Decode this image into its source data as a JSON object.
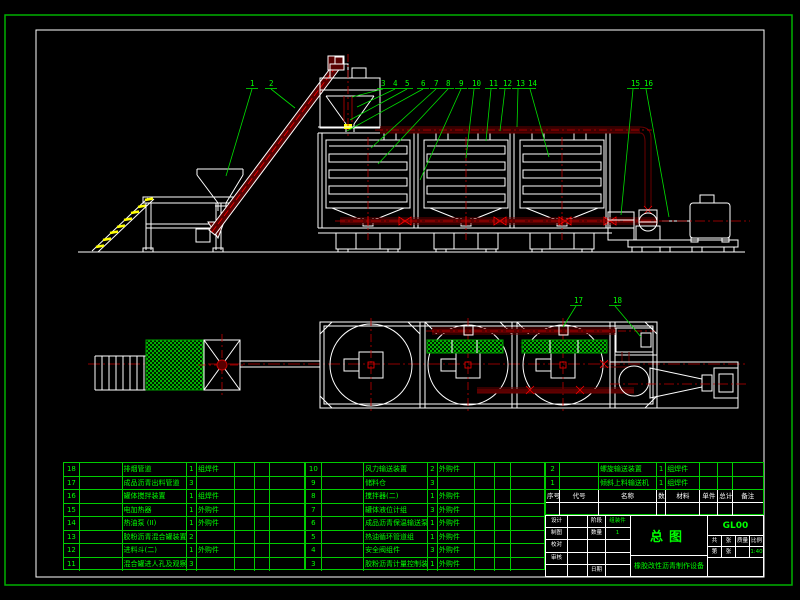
{
  "sheet": {
    "type": "CAD assembly drawing",
    "colors": {
      "background": "#000000",
      "outer_frame_green": "#00b000",
      "inner_frame_white": "#ffffff",
      "drawing_white": "#ffffff",
      "pipe_maroon": "#6a0000",
      "centerline_red": "#cc0000",
      "valve_red": "#ff0000",
      "callout_green": "#00ff00",
      "table_green": "#00cc00",
      "stair_yellow": "#ffff00",
      "hatch_green": "#00b400"
    }
  },
  "title_block": {
    "drawing_title": "总图",
    "drawing_no": "GL00",
    "product_name": "橡胶改性沥青制作设备",
    "scale_value": "1:40",
    "sig_rows": [
      [
        "设计",
        "",
        "阶段",
        "组装件"
      ],
      [
        "制图",
        "",
        "数量",
        "1"
      ],
      [
        "校对",
        "",
        "",
        ""
      ],
      [
        "审核",
        "",
        "",
        ""
      ],
      [
        "",
        "",
        "日期",
        ""
      ]
    ],
    "info_row1": [
      "共",
      "张",
      "质量",
      "比例"
    ],
    "info_row2": [
      "第",
      "张",
      "",
      "1:40"
    ]
  },
  "bom": {
    "header": [
      "序号",
      "代号",
      "名称",
      "数量",
      "材料",
      "单件",
      "总计",
      "备注"
    ],
    "left_rows": [
      [
        "18",
        "",
        "排烟管道",
        "1",
        "组焊件"
      ],
      [
        "17",
        "",
        "成品沥青出料管道",
        "3",
        ""
      ],
      [
        "16",
        "",
        "罐体搅拌装置",
        "1",
        "组焊件"
      ],
      [
        "15",
        "",
        "电加热器",
        "1",
        "外购件"
      ],
      [
        "14",
        "",
        "热油泵 (II)",
        "1",
        "外购件"
      ],
      [
        "13",
        "",
        "胶粉沥青混合罐装置",
        "2",
        ""
      ],
      [
        "12",
        "",
        "进料斗(二)",
        "1",
        "外购件"
      ],
      [
        "11",
        "",
        "混合罐进人孔及观察装置",
        "3",
        ""
      ]
    ],
    "middle_rows": [
      [
        "10",
        "",
        "风力输送装置",
        "2",
        "外购件"
      ],
      [
        "9",
        "",
        "储料仓",
        "3",
        ""
      ],
      [
        "8",
        "",
        "搅拌器(二)",
        "1",
        "外购件"
      ],
      [
        "7",
        "",
        "罐体液位计组",
        "3",
        "外购件"
      ],
      [
        "6",
        "",
        "成品沥青保温输送泵",
        "1",
        "外购件"
      ],
      [
        "5",
        "",
        "热油循环管道组",
        "1",
        "外购件"
      ],
      [
        "4",
        "",
        "安全阀组件",
        "3",
        "外购件"
      ],
      [
        "3",
        "",
        "胶粉沥青计量控制装置",
        "1",
        "外购件"
      ]
    ],
    "right_rows": [
      [
        "2",
        "",
        "螺旋输送装置",
        "1",
        "组焊件"
      ],
      [
        "1",
        "",
        "倾斜上料输送机",
        "1",
        "组焊件"
      ]
    ]
  },
  "callouts": [
    {
      "label": "1",
      "x": 250,
      "y": 86,
      "tx": 226,
      "ty": 176
    },
    {
      "label": "2",
      "x": 269,
      "y": 86,
      "tx": 295,
      "ty": 108
    },
    {
      "label": "3",
      "x": 381,
      "y": 86,
      "tx": 352,
      "ty": 97
    },
    {
      "label": "4",
      "x": 393,
      "y": 86,
      "tx": 357,
      "ty": 107
    },
    {
      "label": "5",
      "x": 405,
      "y": 86,
      "tx": 350,
      "ty": 120
    },
    {
      "label": "6",
      "x": 421,
      "y": 86,
      "tx": 347,
      "ty": 131
    },
    {
      "label": "7",
      "x": 434,
      "y": 86,
      "tx": 371,
      "ty": 148
    },
    {
      "label": "8",
      "x": 446,
      "y": 86,
      "tx": 378,
      "ty": 164
    },
    {
      "label": "9",
      "x": 459,
      "y": 86,
      "tx": 420,
      "ty": 180
    },
    {
      "label": "10",
      "x": 472,
      "y": 86,
      "tx": 466,
      "ty": 158
    },
    {
      "label": "11",
      "x": 489,
      "y": 86,
      "tx": 486,
      "ty": 141
    },
    {
      "label": "12",
      "x": 503,
      "y": 86,
      "tx": 500,
      "ty": 131
    },
    {
      "label": "13",
      "x": 516,
      "y": 86,
      "tx": 517,
      "ty": 127
    },
    {
      "label": "14",
      "x": 528,
      "y": 86,
      "tx": 549,
      "ty": 157
    },
    {
      "label": "15",
      "x": 631,
      "y": 86,
      "tx": 621,
      "ty": 215
    },
    {
      "label": "16",
      "x": 644,
      "y": 86,
      "tx": 669,
      "ty": 217
    },
    {
      "label": "17",
      "x": 574,
      "y": 303,
      "tx": 563,
      "ty": 327
    },
    {
      "label": "18",
      "x": 613,
      "y": 303,
      "tx": 641,
      "ty": 337
    }
  ]
}
